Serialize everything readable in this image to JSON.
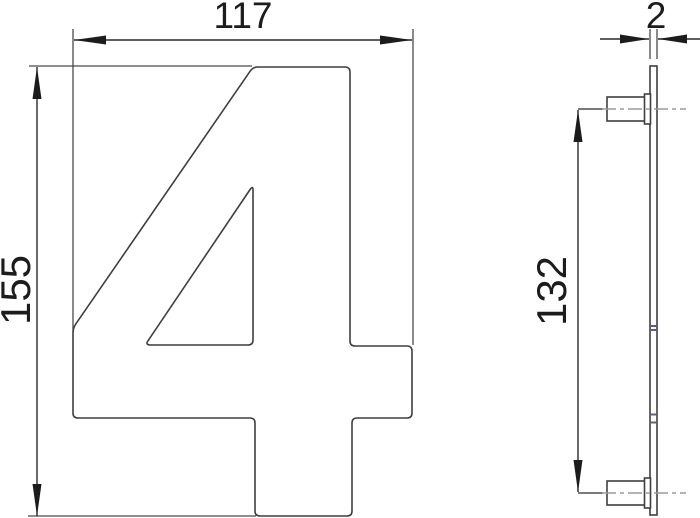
{
  "drawing": {
    "figure": "house-number-numeral-4-technical-drawing",
    "front_view": {
      "part": "numeral-4-plate",
      "width_label": "117",
      "height_label": "155"
    },
    "side_view": {
      "part": "plate-profile-with-mounting-studs",
      "thickness_label": "2",
      "stud_spacing_label": "132"
    }
  },
  "colors": {
    "background": "#ffffff",
    "line": "#3f3f3f",
    "dimension": "#2a2a2a",
    "text": "#1c1c1c",
    "centerline": "#9a9a9a",
    "plate_marks": "#5d5d86"
  }
}
